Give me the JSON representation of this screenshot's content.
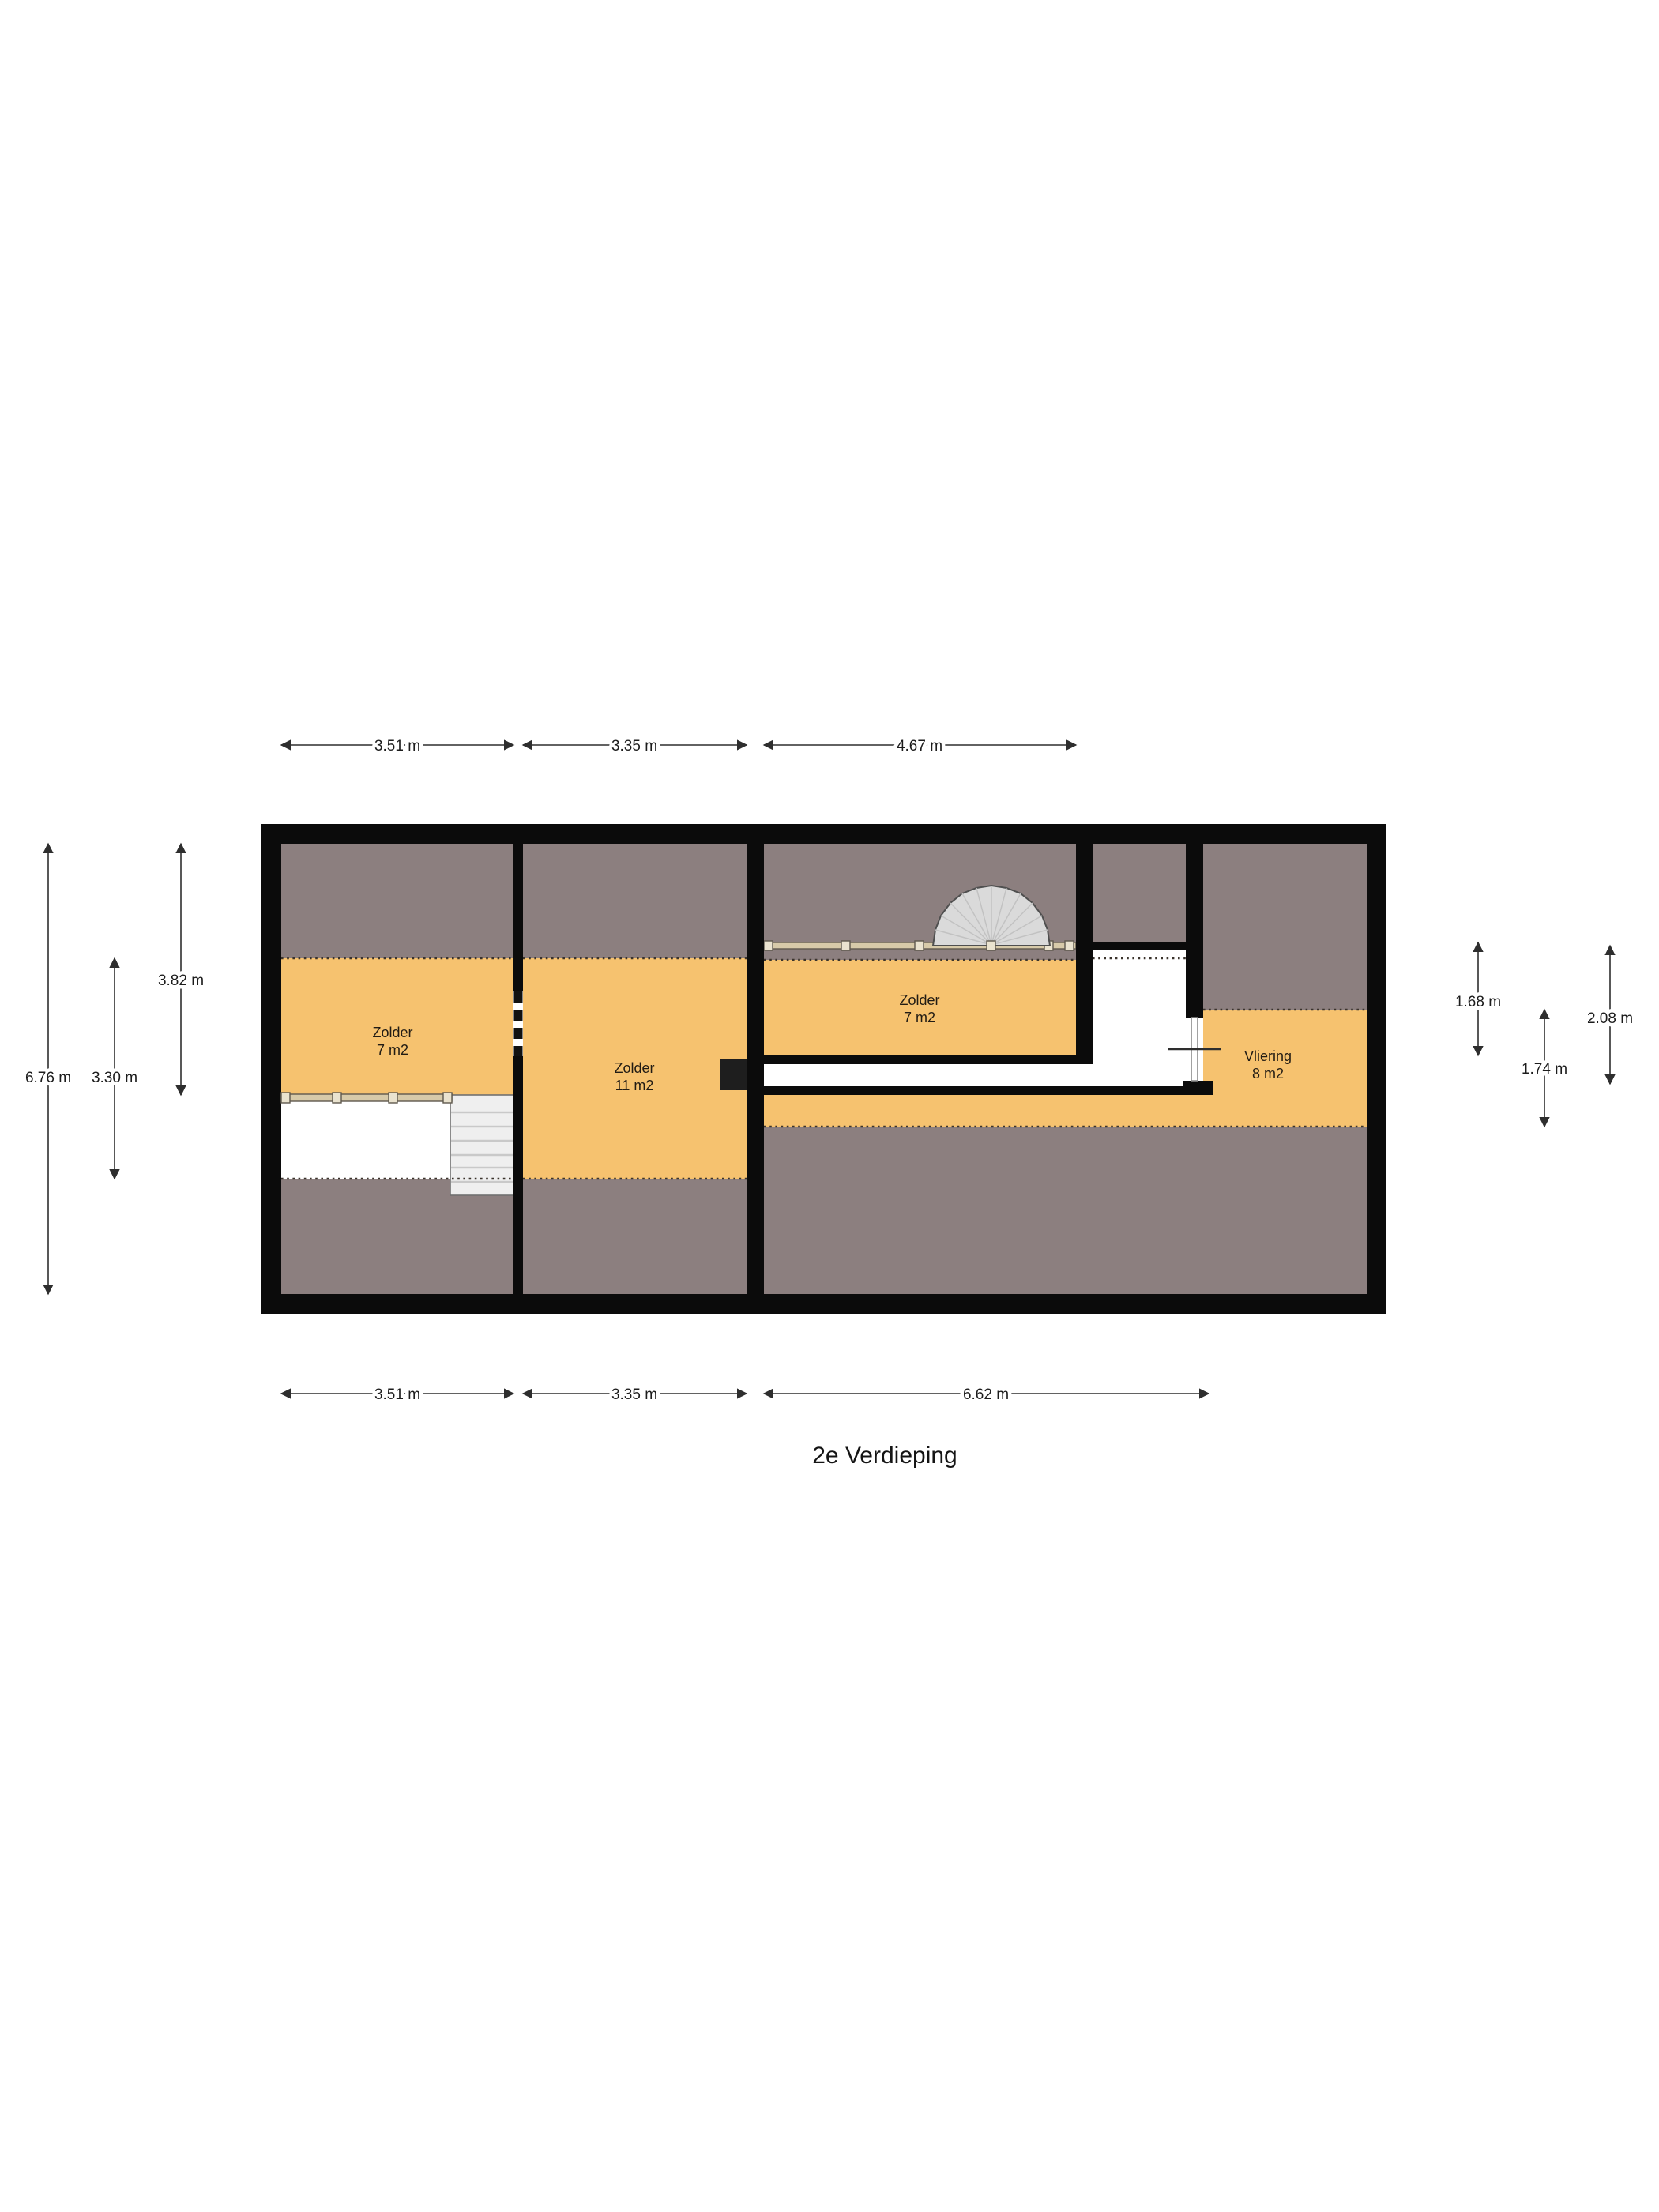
{
  "title": "2e Verdieping",
  "rooms": [
    {
      "name": "Zolder",
      "area": "7 m2"
    },
    {
      "name": "Zolder",
      "area": "11 m2"
    },
    {
      "name": "Zolder",
      "area": "7 m2"
    },
    {
      "name": "Vliering",
      "area": "8 m2"
    }
  ],
  "dimensions": {
    "top": [
      "3.51 m",
      "3.35 m",
      "4.67 m"
    ],
    "bottom": [
      "3.51 m",
      "3.35 m",
      "6.62 m"
    ],
    "left": [
      "6.76 m",
      "3.30 m",
      "3.82 m"
    ],
    "right": [
      "1.68 m",
      "2.08 m",
      "1.74 m"
    ]
  },
  "colors": {
    "floor": "#F6C26F",
    "roof_slope": "#8C7F7F",
    "wall": "#0b0b0b",
    "stairs": "#EFEFEF",
    "spiral": "#DADADA",
    "railing": "#D7CAA9",
    "dotted": "#3a332c"
  }
}
